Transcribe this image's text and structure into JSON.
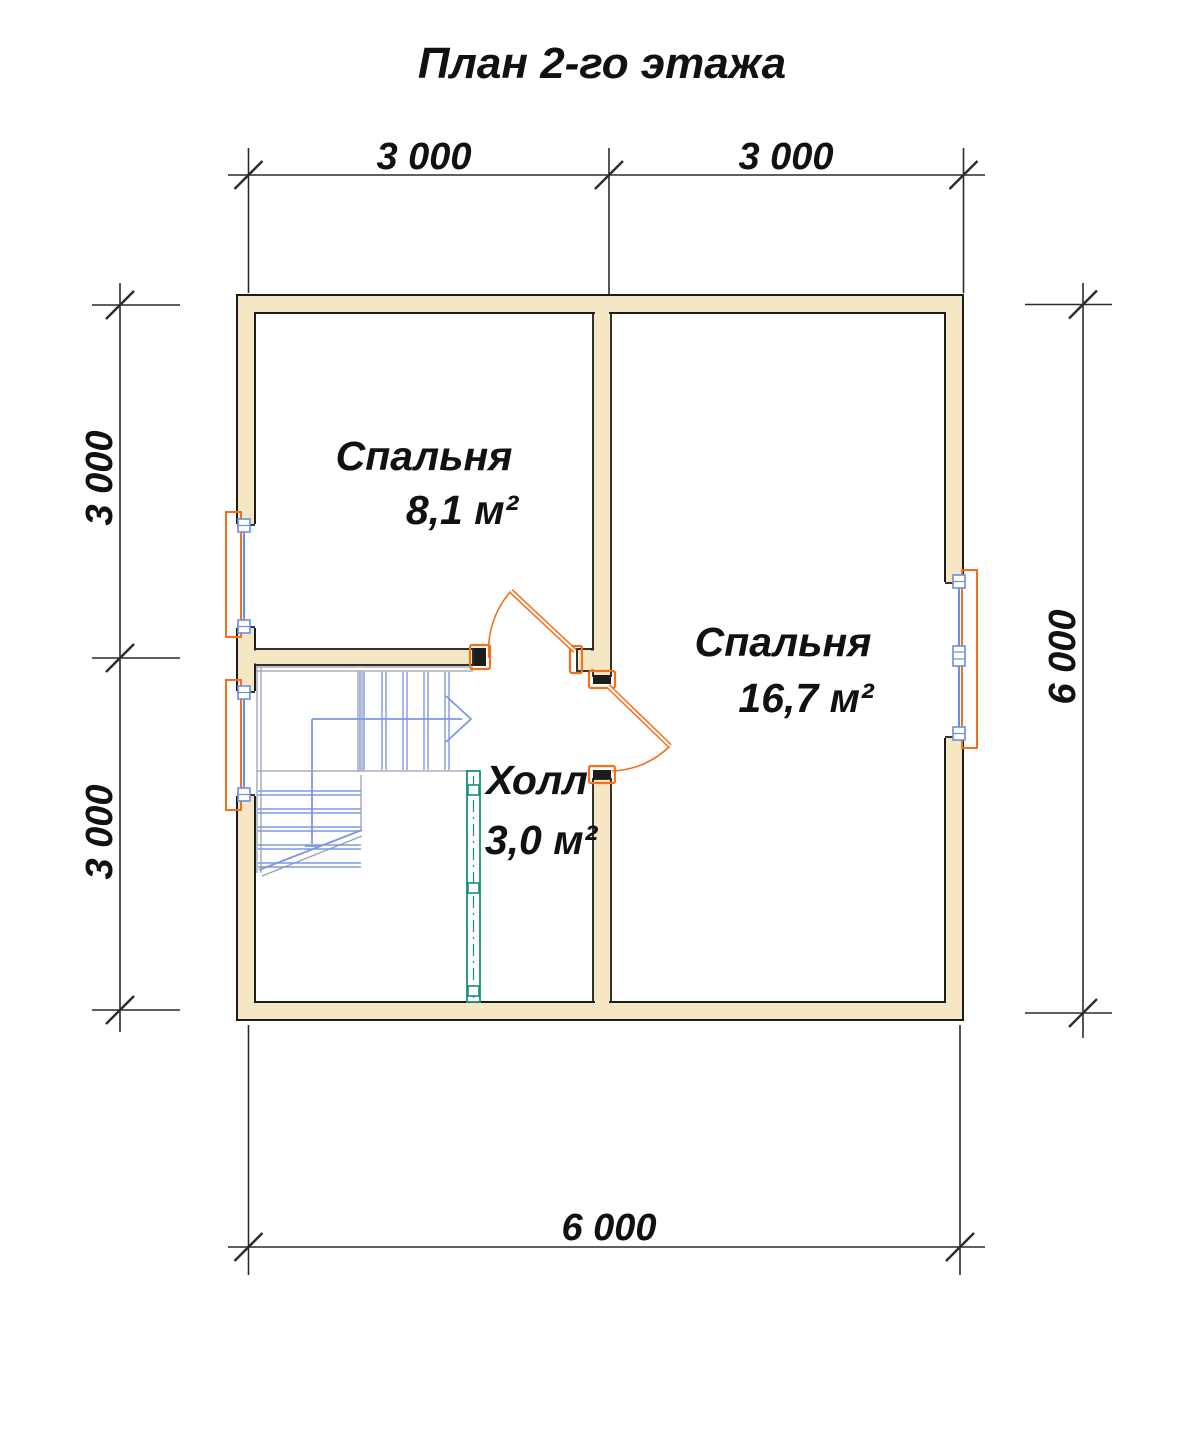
{
  "title": "План 2-го этажа",
  "dimensions": {
    "top": [
      "3 000",
      "3 000"
    ],
    "left": [
      "3 000",
      "3 000"
    ],
    "right": [
      "6 000"
    ],
    "bottom": [
      "6 000"
    ]
  },
  "rooms": {
    "bedroom1": {
      "name": "Спальня",
      "area": "8,1 м²"
    },
    "bedroom2": {
      "name": "Спальня",
      "area": "16,7 м²"
    },
    "hall": {
      "name": "Холл",
      "area": "3,0 м²"
    }
  },
  "colors": {
    "wall_fill": "#F5E7C4",
    "wall_outline": "#1C1C1C",
    "door_window_orange": "#F2711C",
    "window_blue": "#6E8EE0",
    "stair_blue": "#7D97E3",
    "stair_gray": "#98A0AE",
    "railing_teal": "#17907D",
    "text": "#111111",
    "background": "#FFFFFF"
  }
}
